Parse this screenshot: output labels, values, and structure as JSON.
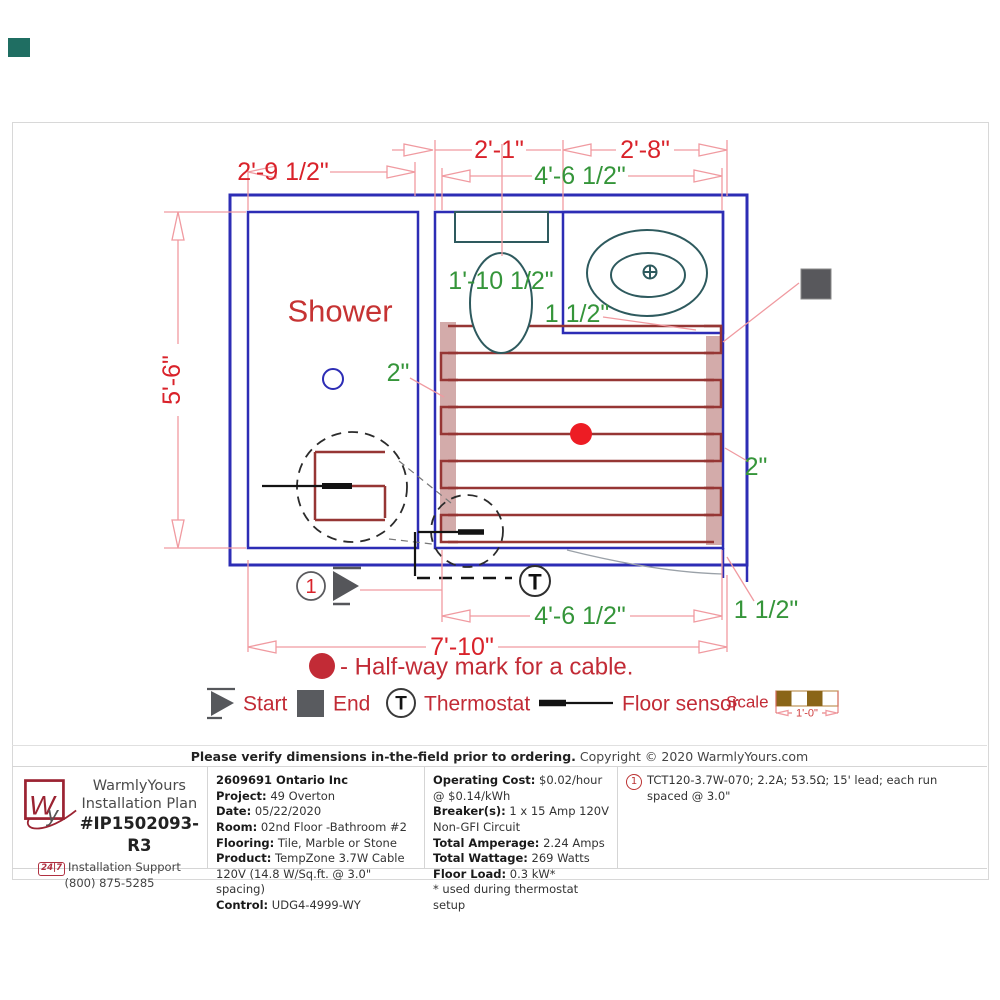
{
  "plan": {
    "shower_label": "Shower",
    "dim": {
      "shower_width": "2'-9 1/2\"",
      "toilet_width": "2'-1\"",
      "vanity_width": "2'-8\"",
      "mat_width_top": "4'-6 1/2\"",
      "room_height": "5'-6\"",
      "toilet_offset": "1'-10 1/2\"",
      "counter_gap": "1 1/2\"",
      "left_gap": "2\"",
      "right_gap": "2\"",
      "mat_width_bottom": "4'-6 1/2\"",
      "room_width": "7'-10\"",
      "door_gap": "1 1/2\""
    },
    "start_number": "1",
    "thermostat_letter": "T"
  },
  "legend": {
    "halfway_label": "- Half-way mark for a cable.",
    "start_label": "Start",
    "end_label": "End",
    "thermostat_symbol": "T",
    "thermostat_label": "Thermostat",
    "floor_sensor_label": "Floor sensor",
    "scale_label": "Scale",
    "scale_value": "1'-0\""
  },
  "notice": {
    "bold_text": "Please verify dimensions in-the-field prior to ordering.",
    "copyright_text": "Copyright © 2020 WarmlyYours.com"
  },
  "footer": {
    "brand": {
      "logo_w": "W",
      "logo_y": "y",
      "name": "WarmlyYours",
      "subtitle": "Installation Plan",
      "plan_number": "#IP1502093-R3",
      "support_badge": "24|7",
      "support_text": "Installation Support (800) 875-5285"
    },
    "project": {
      "company": "2609691 Ontario Inc",
      "fields": [
        {
          "label": "Project:",
          "value": "49 Overton"
        },
        {
          "label": "Date:",
          "value": "05/22/2020"
        },
        {
          "label": "Room:",
          "value": "02nd Floor -Bathroom #2"
        },
        {
          "label": "Flooring:",
          "value": "Tile, Marble or Stone"
        },
        {
          "label": "Product:",
          "value": "TempZone 3.7W Cable 120V (14.8 W/Sq.ft. @ 3.0\" spacing)"
        },
        {
          "label": "Control:",
          "value": "UDG4-4999-WY"
        }
      ]
    },
    "electrical": {
      "fields": [
        {
          "label": "Operating Cost:",
          "value": "$0.02/hour @ $0.14/kWh"
        },
        {
          "label": "Breaker(s):",
          "value": "1 x 15 Amp 120V Non-GFI Circuit"
        },
        {
          "label": "Total Amperage:",
          "value": "2.24 Amps"
        },
        {
          "label": "Total Wattage:",
          "value": "269 Watts"
        },
        {
          "label": "Floor Load:",
          "value": "0.3 kW*"
        }
      ],
      "footnote": "* used during thermostat setup"
    },
    "product_note": {
      "number": "1",
      "text": "TCT120-3.7W-070; 2.2A; 53.5Ω; 15' lead; each run spaced @ 3.0\""
    }
  },
  "colors": {
    "wall_blue": "#2d2db5",
    "dim_red": "#d9222a",
    "dim_green": "#35953a",
    "cable_red": "#963634",
    "halfway_dot_red": "#ed1c24",
    "marker_gray": "#55565a",
    "badge_teal": "#1f6e62",
    "scale_brown": "#8a6518"
  }
}
